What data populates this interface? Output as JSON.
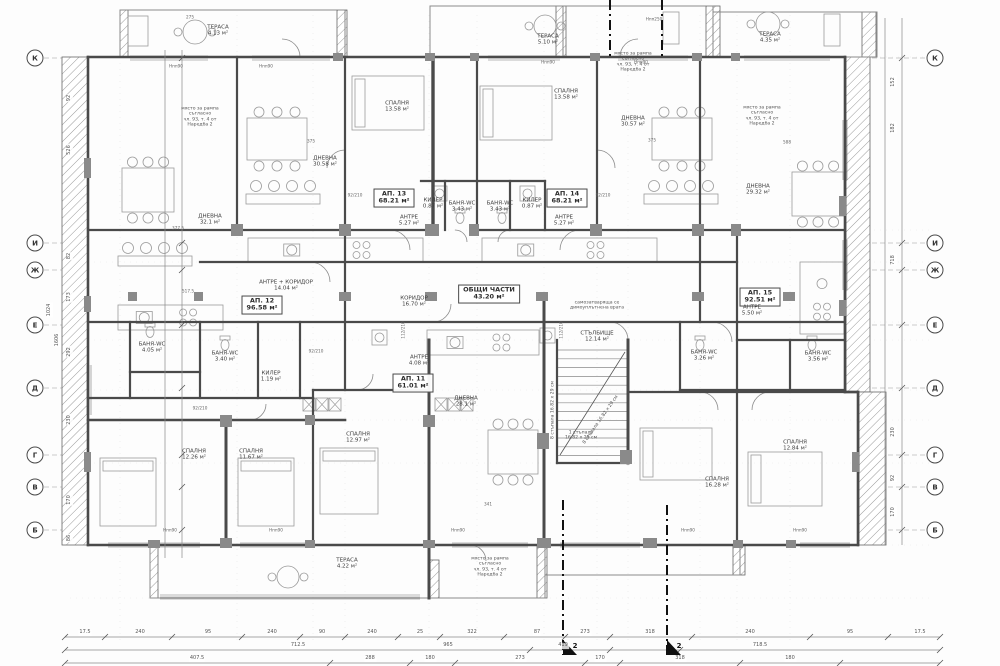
{
  "page": {
    "background": "#ffffff",
    "line_color": "#4a4a4a",
    "text_color": "#3d3d3d"
  },
  "plan": {
    "apartments": [
      {
        "id": "АП. 11",
        "area": "61.01 м²"
      },
      {
        "id": "АП. 12",
        "area": "96.58 м²"
      },
      {
        "id": "АП. 13",
        "area": "68.21 м²"
      },
      {
        "id": "АП. 14",
        "area": "68.21 м²"
      },
      {
        "id": "АП. 15",
        "area": "92.51 м²"
      }
    ],
    "common_areas": [
      {
        "name": "ОБЩИ ЧАСТИ",
        "area": "43.20 м²"
      },
      {
        "name": "КОРИДОР",
        "area": "16.70 м²"
      },
      {
        "name": "СТЪЛБИЩЕ",
        "area": "12.14 м²"
      }
    ],
    "axes": {
      "left": [
        {
          "l": "К",
          "y": 58
        },
        {
          "l": "И",
          "y": 243
        },
        {
          "l": "Ж",
          "y": 270
        },
        {
          "l": "Е",
          "y": 325
        },
        {
          "l": "Д",
          "y": 388
        },
        {
          "l": "Г",
          "y": 455
        },
        {
          "l": "В",
          "y": 487
        },
        {
          "l": "Б",
          "y": 530
        }
      ],
      "right": [
        {
          "l": "К",
          "y": 58
        },
        {
          "l": "И",
          "y": 243
        },
        {
          "l": "Ж",
          "y": 270
        },
        {
          "l": "Е",
          "y": 325
        },
        {
          "l": "Д",
          "y": 388
        },
        {
          "l": "Г",
          "y": 455
        },
        {
          "l": "В",
          "y": 487
        },
        {
          "l": "Б",
          "y": 530
        }
      ]
    },
    "section_marks": [
      {
        "label": "2",
        "x": 575,
        "y": 646
      },
      {
        "label": "2",
        "x": 679,
        "y": 646
      }
    ],
    "labels": [
      {
        "n": "label-ap13",
        "cls": "ap",
        "t": [
          "АП. 13",
          "68.21 м²"
        ],
        "x": 394,
        "y": 198
      },
      {
        "n": "label-ap14",
        "cls": "ap",
        "t": [
          "АП. 14",
          "68.21 м²"
        ],
        "x": 567,
        "y": 198
      },
      {
        "n": "label-ap12",
        "cls": "ap",
        "t": [
          "АП. 12",
          "96.58 м²"
        ],
        "x": 262,
        "y": 305
      },
      {
        "n": "label-ap15",
        "cls": "ap",
        "t": [
          "АП. 15",
          "92.51 м²"
        ],
        "x": 760,
        "y": 297
      },
      {
        "n": "label-ap11",
        "cls": "ap",
        "t": [
          "АП. 11",
          "61.01 м²"
        ],
        "x": 413,
        "y": 383
      },
      {
        "n": "label-common-parts",
        "cls": "ap",
        "t": [
          "ОБЩИ ЧАСТИ",
          "43.20 м²"
        ],
        "x": 489,
        "y": 294
      },
      {
        "n": "label-terrace-1",
        "cls": "room",
        "t": [
          "ТЕРАСА",
          "4.13 м²"
        ],
        "x": 218,
        "y": 31
      },
      {
        "n": "label-terrace-2",
        "cls": "room",
        "t": [
          "ТЕРАСА",
          "5.10 м²"
        ],
        "x": 548,
        "y": 40
      },
      {
        "n": "label-terrace-3",
        "cls": "room",
        "t": [
          "ТЕРАСА",
          "4.35 м²"
        ],
        "x": 770,
        "y": 38
      },
      {
        "n": "label-terrace-4",
        "cls": "room",
        "t": [
          "ТЕРАСА",
          "4.22 м²"
        ],
        "x": 347,
        "y": 564
      },
      {
        "n": "label-bedroom-13",
        "cls": "room",
        "t": [
          "СПАЛНЯ",
          "13.58 м²"
        ],
        "x": 397,
        "y": 107
      },
      {
        "n": "label-bedroom-14",
        "cls": "room",
        "t": [
          "СПАЛНЯ",
          "13.58 м²"
        ],
        "x": 566,
        "y": 95
      },
      {
        "n": "label-living-13",
        "cls": "room",
        "t": [
          "ДНЕВНА",
          "30.58 м²"
        ],
        "x": 325,
        "y": 162
      },
      {
        "n": "label-living-14",
        "cls": "room",
        "t": [
          "ДНЕВНА",
          "30.57 м²"
        ],
        "x": 633,
        "y": 122
      },
      {
        "n": "label-living-12",
        "cls": "room",
        "t": [
          "ДНЕВНА",
          "32.1 м²"
        ],
        "x": 210,
        "y": 220
      },
      {
        "n": "label-living-15",
        "cls": "room",
        "t": [
          "ДНЕВНА",
          "29.32 м²"
        ],
        "x": 758,
        "y": 190
      },
      {
        "n": "label-living-11",
        "cls": "room",
        "t": [
          "ДНЕВНА",
          "28.1 м²"
        ],
        "x": 466,
        "y": 402
      },
      {
        "n": "label-closet-13",
        "cls": "room",
        "t": [
          "КИЛЕР",
          "0.87 м²"
        ],
        "x": 433,
        "y": 204
      },
      {
        "n": "label-closet-14",
        "cls": "room",
        "t": [
          "КИЛЕР",
          "0.87 м²"
        ],
        "x": 532,
        "y": 204
      },
      {
        "n": "label-closet-12",
        "cls": "room",
        "t": [
          "КИЛЕР",
          "1.19 м²"
        ],
        "x": 271,
        "y": 377
      },
      {
        "n": "label-bath-13",
        "cls": "room",
        "t": [
          "БАНЯ-WC",
          "3.43 м²"
        ],
        "x": 462,
        "y": 207
      },
      {
        "n": "label-bath-14",
        "cls": "room",
        "t": [
          "БАНЯ-WC",
          "3.43 м²"
        ],
        "x": 500,
        "y": 207
      },
      {
        "n": "label-bath-12a",
        "cls": "room",
        "t": [
          "БАНЯ-WC",
          "4.05 м²"
        ],
        "x": 152,
        "y": 348
      },
      {
        "n": "label-bath-12b",
        "cls": "room",
        "t": [
          "БАНЯ-WC",
          "3.40 м²"
        ],
        "x": 225,
        "y": 357
      },
      {
        "n": "label-bath-15a",
        "cls": "room",
        "t": [
          "БАНЯ-WC",
          "3.26 м²"
        ],
        "x": 704,
        "y": 356
      },
      {
        "n": "label-bath-15b",
        "cls": "room",
        "t": [
          "БАНЯ-WC",
          "3.56 м²"
        ],
        "x": 818,
        "y": 357
      },
      {
        "n": "label-antre-13",
        "cls": "room",
        "t": [
          "АНТРЕ",
          "5.27 м²"
        ],
        "x": 409,
        "y": 221
      },
      {
        "n": "label-antre-14",
        "cls": "room",
        "t": [
          "АНТРЕ",
          "5.27 м²"
        ],
        "x": 564,
        "y": 221
      },
      {
        "n": "label-antre-11",
        "cls": "room",
        "t": [
          "АНТРЕ",
          "4.08 м²"
        ],
        "x": 419,
        "y": 361
      },
      {
        "n": "label-antre-15",
        "cls": "room",
        "t": [
          "АНТРЕ",
          "5.50 м²"
        ],
        "x": 752,
        "y": 311
      },
      {
        "n": "label-antre-koridor-12",
        "cls": "room",
        "t": [
          "АНТРЕ + КОРИДОР",
          "14.04 м²"
        ],
        "x": 286,
        "y": 286
      },
      {
        "n": "label-koridor",
        "cls": "room",
        "t": [
          "КОРИДОР",
          "16.70 м²"
        ],
        "x": 414,
        "y": 302
      },
      {
        "n": "label-stairs",
        "cls": "room",
        "t": [
          "СТЪЛБИЩЕ",
          "12.14 м²"
        ],
        "x": 597,
        "y": 337
      },
      {
        "n": "label-bedroom-b1",
        "cls": "room",
        "t": [
          "СПАЛНЯ",
          "12.26 м²"
        ],
        "x": 194,
        "y": 455
      },
      {
        "n": "label-bedroom-b2",
        "cls": "room",
        "t": [
          "СПАЛНЯ",
          "11.67 м²"
        ],
        "x": 251,
        "y": 455
      },
      {
        "n": "label-bedroom-b3",
        "cls": "room",
        "t": [
          "СПАЛНЯ",
          "12.97 м²"
        ],
        "x": 358,
        "y": 438
      },
      {
        "n": "label-bedroom-b4",
        "cls": "room",
        "t": [
          "СПАЛНЯ",
          "16.28 м²"
        ],
        "x": 717,
        "y": 483
      },
      {
        "n": "label-bedroom-b5",
        "cls": "room",
        "t": [
          "СПАЛНЯ",
          "12.84 м²"
        ],
        "x": 795,
        "y": 446
      },
      {
        "n": "note-ramp-1",
        "cls": "note",
        "t": [
          "място за рампа",
          "съгласно",
          "чл. 93, т. 4 от",
          "Наредба 2"
        ],
        "x": 200,
        "y": 117
      },
      {
        "n": "note-ramp-2",
        "cls": "note",
        "t": [
          "място за рампа",
          "съгласно",
          "чл. 93, т. 4 от",
          "Наредба 2"
        ],
        "x": 633,
        "y": 62
      },
      {
        "n": "note-ramp-3",
        "cls": "note",
        "t": [
          "място за рампа",
          "съгласно",
          "чл. 93, т. 4 от",
          "Наредба 2"
        ],
        "x": 762,
        "y": 116
      },
      {
        "n": "note-ramp-4",
        "cls": "note",
        "t": [
          "място за рампа",
          "съгласно",
          "чл. 93, т. 4 от",
          "Наредба 2"
        ],
        "x": 490,
        "y": 567
      },
      {
        "n": "note-door",
        "cls": "note",
        "t": [
          "самозатваряща се",
          "димоуплътнена врата"
        ],
        "x": 597,
        "y": 306
      },
      {
        "n": "note-stair-step",
        "cls": "note",
        "t": [
          "1 стъпало",
          "16.82 х 29 см"
        ],
        "x": 581,
        "y": 436
      },
      {
        "n": "note-stair-8a",
        "cls": "note",
        "t": [
          "8 стъпала 16.82 х 29 см"
        ],
        "x": 553,
        "y": 410,
        "rot": -90
      },
      {
        "n": "note-stair-8b",
        "cls": "note",
        "t": [
          "8 стъпала 16.82 х 29 см"
        ],
        "x": 601,
        "y": 420,
        "rot": -55
      },
      {
        "n": "sill-1",
        "cls": "tiny",
        "t": [
          "Нпп90"
        ],
        "x": 176,
        "y": 67
      },
      {
        "n": "sill-2",
        "cls": "tiny",
        "t": [
          "Нпп90"
        ],
        "x": 266,
        "y": 67
      },
      {
        "n": "sill-3",
        "cls": "tiny",
        "t": [
          "Нпп90"
        ],
        "x": 548,
        "y": 63
      },
      {
        "n": "sill-4",
        "cls": "tiny",
        "t": [
          "Нпп90"
        ],
        "x": 641,
        "y": 63
      },
      {
        "n": "sill-5",
        "cls": "tiny",
        "t": [
          "Нпп250"
        ],
        "x": 654,
        "y": 20
      },
      {
        "n": "sill-6",
        "cls": "tiny",
        "t": [
          "Нпп90"
        ],
        "x": 170,
        "y": 531
      },
      {
        "n": "sill-7",
        "cls": "tiny",
        "t": [
          "Нпп90"
        ],
        "x": 276,
        "y": 531
      },
      {
        "n": "sill-8",
        "cls": "tiny",
        "t": [
          "Нпп90"
        ],
        "x": 458,
        "y": 531
      },
      {
        "n": "sill-9",
        "cls": "tiny",
        "t": [
          "Нпп90"
        ],
        "x": 688,
        "y": 531
      },
      {
        "n": "sill-10",
        "cls": "tiny",
        "t": [
          "Нпп90"
        ],
        "x": 800,
        "y": 531
      },
      {
        "n": "door-size-1",
        "cls": "tiny",
        "t": [
          "92/210"
        ],
        "x": 355,
        "y": 196
      },
      {
        "n": "door-size-2",
        "cls": "tiny",
        "t": [
          "92/210"
        ],
        "x": 603,
        "y": 196
      },
      {
        "n": "door-size-3",
        "cls": "tiny",
        "t": [
          "92/210"
        ],
        "x": 316,
        "y": 352
      },
      {
        "n": "door-size-4",
        "cls": "tiny",
        "t": [
          "92/210"
        ],
        "x": 200,
        "y": 409
      },
      {
        "n": "door-size-5",
        "cls": "tiny",
        "t": [
          "112/210"
        ],
        "x": 404,
        "y": 330,
        "rot": -90
      },
      {
        "n": "door-size-6",
        "cls": "tiny",
        "t": [
          "112/210"
        ],
        "x": 562,
        "y": 330,
        "rot": -90
      },
      {
        "n": "dim-in-1",
        "cls": "tiny",
        "t": [
          "377.5"
        ],
        "x": 178,
        "y": 229
      },
      {
        "n": "dim-in-2",
        "cls": "tiny",
        "t": [
          "517.5"
        ],
        "x": 188,
        "y": 292
      },
      {
        "n": "dim-in-3",
        "cls": "tiny",
        "t": [
          "341"
        ],
        "x": 488,
        "y": 505
      },
      {
        "n": "dim-in-4",
        "cls": "tiny",
        "t": [
          "588"
        ],
        "x": 787,
        "y": 143
      },
      {
        "n": "dim-in-5",
        "cls": "tiny",
        "t": [
          "375"
        ],
        "x": 652,
        "y": 141
      },
      {
        "n": "dim-in-6",
        "cls": "tiny",
        "t": [
          "375"
        ],
        "x": 311,
        "y": 142
      },
      {
        "n": "dim-in-7",
        "cls": "tiny",
        "t": [
          "275"
        ],
        "x": 190,
        "y": 18
      }
    ],
    "dims": [
      {
        "v": "17.5",
        "x": 85,
        "y": 633
      },
      {
        "v": "240",
        "x": 140,
        "y": 633
      },
      {
        "v": "95",
        "x": 208,
        "y": 633
      },
      {
        "v": "240",
        "x": 272,
        "y": 633
      },
      {
        "v": "90",
        "x": 322,
        "y": 633
      },
      {
        "v": "240",
        "x": 372,
        "y": 633
      },
      {
        "v": "25",
        "x": 420,
        "y": 633
      },
      {
        "v": "322",
        "x": 472,
        "y": 633
      },
      {
        "v": "87",
        "x": 537,
        "y": 633
      },
      {
        "v": "273",
        "x": 585,
        "y": 633
      },
      {
        "v": "318",
        "x": 650,
        "y": 633
      },
      {
        "v": "240",
        "x": 750,
        "y": 633
      },
      {
        "v": "95",
        "x": 850,
        "y": 633
      },
      {
        "v": "17.5",
        "x": 920,
        "y": 633
      },
      {
        "v": "712.5",
        "x": 298,
        "y": 646
      },
      {
        "v": "965",
        "x": 448,
        "y": 646
      },
      {
        "v": "419",
        "x": 563,
        "y": 646
      },
      {
        "v": "718.5",
        "x": 760,
        "y": 646
      },
      {
        "v": "407.5",
        "x": 197,
        "y": 659
      },
      {
        "v": "288",
        "x": 370,
        "y": 659
      },
      {
        "v": "180",
        "x": 430,
        "y": 659
      },
      {
        "v": "273",
        "x": 520,
        "y": 659
      },
      {
        "v": "170",
        "x": 600,
        "y": 659
      },
      {
        "v": "318",
        "x": 680,
        "y": 659
      },
      {
        "v": "180",
        "x": 790,
        "y": 659
      },
      {
        "v": "92",
        "x": 70,
        "y": 98,
        "rot": -90
      },
      {
        "v": "526",
        "x": 70,
        "y": 150,
        "rot": -90
      },
      {
        "v": "82",
        "x": 70,
        "y": 256,
        "rot": -90
      },
      {
        "v": "173",
        "x": 70,
        "y": 297,
        "rot": -90
      },
      {
        "v": "292",
        "x": 70,
        "y": 352,
        "rot": -90
      },
      {
        "v": "230",
        "x": 70,
        "y": 420,
        "rot": -90
      },
      {
        "v": "170",
        "x": 70,
        "y": 500,
        "rot": -90
      },
      {
        "v": "86",
        "x": 70,
        "y": 538,
        "rot": -90
      },
      {
        "v": "1024",
        "x": 50,
        "y": 310,
        "rot": -90
      },
      {
        "v": "1606",
        "x": 58,
        "y": 340,
        "rot": -90
      },
      {
        "v": "152",
        "x": 894,
        "y": 82,
        "rot": -90
      },
      {
        "v": "182",
        "x": 894,
        "y": 128,
        "rot": -90
      },
      {
        "v": "718",
        "x": 894,
        "y": 260,
        "rot": -90
      },
      {
        "v": "230",
        "x": 894,
        "y": 432,
        "rot": -90
      },
      {
        "v": "92",
        "x": 894,
        "y": 478,
        "rot": -90
      },
      {
        "v": "170",
        "x": 894,
        "y": 512,
        "rot": -90
      }
    ]
  }
}
